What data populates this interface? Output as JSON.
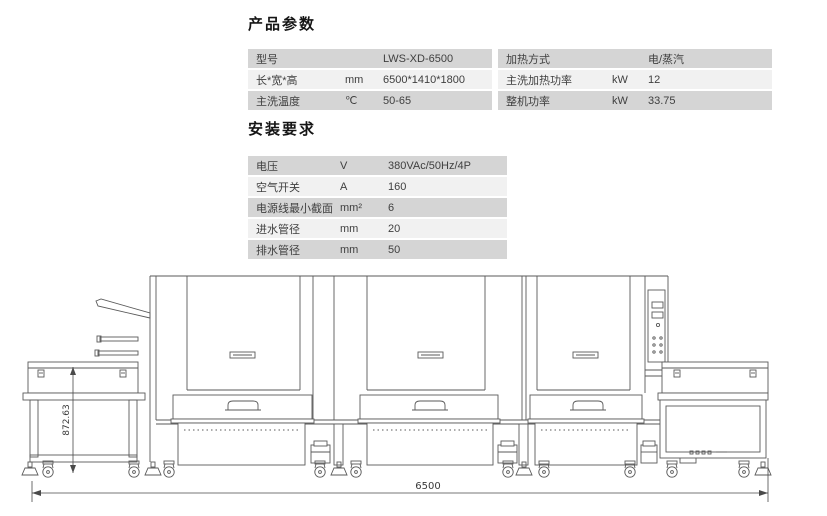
{
  "sections": {
    "product_heading": "产品参数",
    "install_heading": "安装要求"
  },
  "tables": {
    "product_left": {
      "rows": [
        {
          "label": "型号",
          "unit": "",
          "value": "LWS-XD-6500"
        },
        {
          "label": "长*宽*高",
          "unit": "mm",
          "value": "6500*1410*1800"
        },
        {
          "label": "主洗温度",
          "unit": "℃",
          "value": "50-65"
        }
      ]
    },
    "product_right": {
      "rows": [
        {
          "label": "加热方式",
          "unit": "",
          "value": "电/蒸汽"
        },
        {
          "label": "主洗加热功率",
          "unit": "kW",
          "value": "12"
        },
        {
          "label": "整机功率",
          "unit": "kW",
          "value": "33.75"
        }
      ]
    },
    "install": {
      "rows": [
        {
          "label": "电压",
          "unit": "V",
          "value": "380VAc/50Hz/4P"
        },
        {
          "label": "空气开关",
          "unit": "A",
          "value": "160"
        },
        {
          "label": "电源线最小截面",
          "unit": "mm²",
          "value": "6"
        },
        {
          "label": "进水管径",
          "unit": "mm",
          "value": "20"
        },
        {
          "label": "排水管径",
          "unit": "mm",
          "value": "50"
        }
      ]
    }
  },
  "drawing": {
    "height_dim": "872.63",
    "length_dim": "6500"
  },
  "colors": {
    "row_dark": "#d5d5d5",
    "row_light": "#f1f1f1",
    "text": "#3f3f3f",
    "line": "#5a5a5a"
  }
}
